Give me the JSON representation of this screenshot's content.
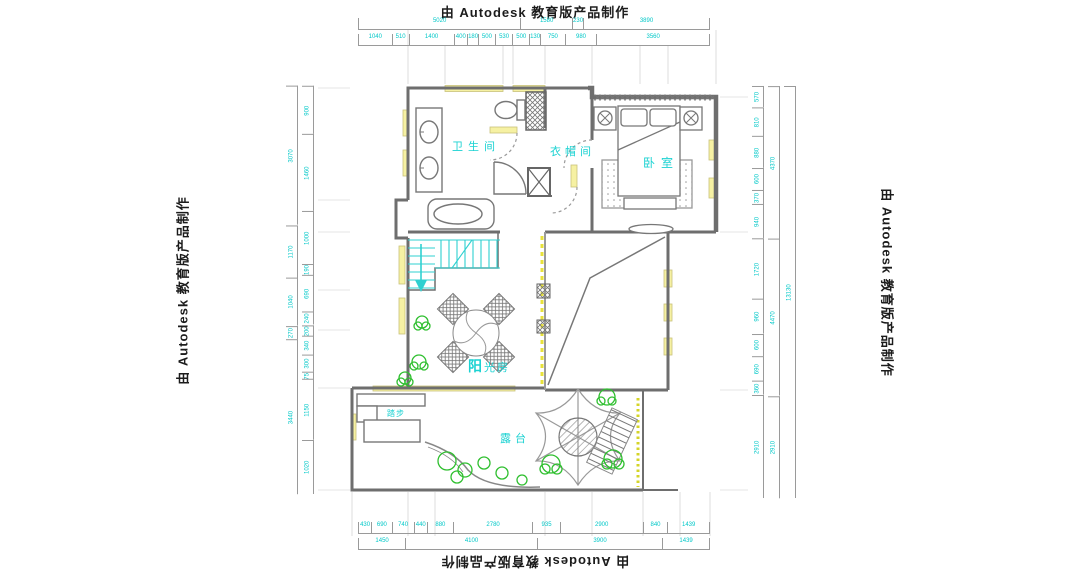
{
  "watermark": {
    "text": "由 Autodesk 教育版产品制作"
  },
  "rooms": {
    "bathroom": "卫生间",
    "cloakroom": "衣帽间",
    "bedroom": "卧室",
    "sunroom_bold": "阳",
    "sunroom_rest": "光房",
    "terrace": "露台",
    "steps": "踏步"
  },
  "colors": {
    "label": "#1bd2d2",
    "dimension": "#00c8c8",
    "window": "#f6f1a3",
    "plant": "#2fbf2f",
    "stair": "#2fd0d0",
    "wall": "#6e6e6e"
  },
  "dimensions": {
    "top_row1": [
      "5020",
      "1580",
      "230",
      "3890"
    ],
    "top_row2": [
      "1040",
      "510",
      "1400",
      "400",
      "180",
      "500",
      "530",
      "500",
      "130",
      "750",
      "980",
      "3560"
    ],
    "bottom_row1": [
      "430",
      "690",
      "740",
      "440",
      "880",
      "2780",
      "935",
      "2900",
      "840",
      "1439"
    ],
    "bottom_row2": [
      "1450",
      "4100",
      "3900",
      "1439"
    ],
    "left_col1": [
      "3070",
      "1170",
      "1040",
      "270",
      "3440"
    ],
    "left_col2": [
      "900",
      "1460",
      "1000",
      "190",
      "690",
      "240",
      "200",
      "340",
      "300",
      "75",
      "1150",
      "1020"
    ],
    "right_col1": [
      "570",
      "810",
      "880",
      "600",
      "370",
      "940",
      "1720",
      "960",
      "600",
      "690",
      "360",
      "2910"
    ],
    "right_col2": [
      "4370",
      "4470",
      "2910"
    ],
    "right_col3": [
      "13130"
    ]
  }
}
